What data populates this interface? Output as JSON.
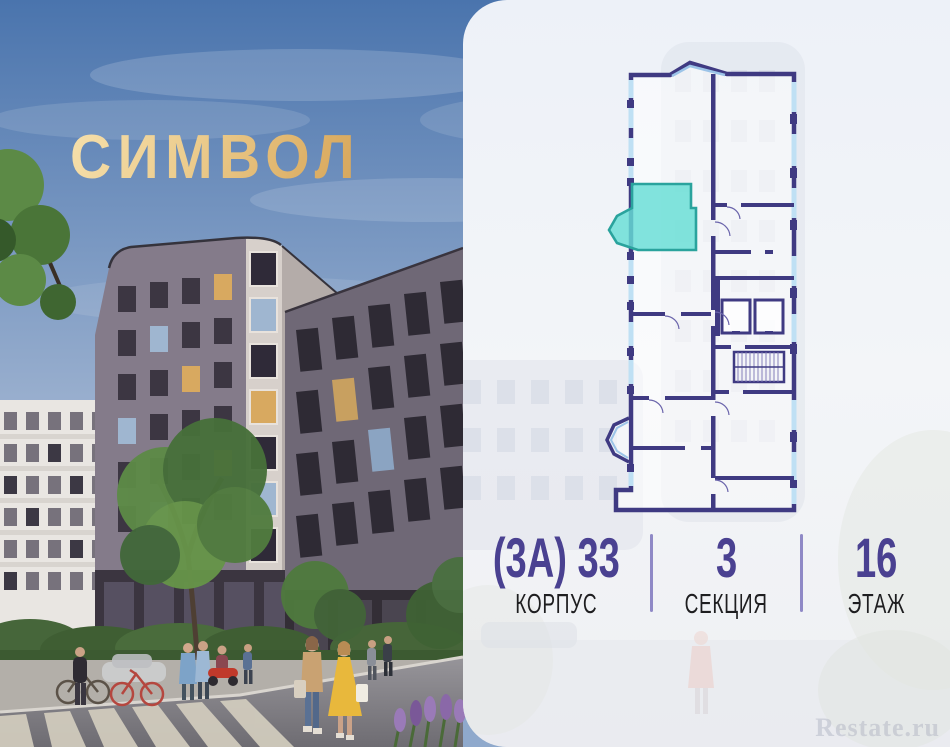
{
  "brand": {
    "logo_text": "СИМВОЛ",
    "logo_color": "#e9c98b"
  },
  "panel": {
    "stats": [
      {
        "value": "(3А) 33",
        "label": "КОРПУС"
      },
      {
        "value": "3",
        "label": "СЕКЦИЯ"
      },
      {
        "value": "16",
        "label": "ЭТАЖ"
      }
    ],
    "watermark": "Restate.ru"
  },
  "colors": {
    "stat_value": "#4a4191",
    "stat_label": "#1e1e20",
    "divider": "#8f89c6",
    "plan_wall": "#3f3a82",
    "plan_window": "#bfe0f4",
    "unit_fill": "#66ded6",
    "unit_border": "#2aa39d",
    "panel_background": "#f0f3f8",
    "sky_top": "#4a74ad"
  }
}
